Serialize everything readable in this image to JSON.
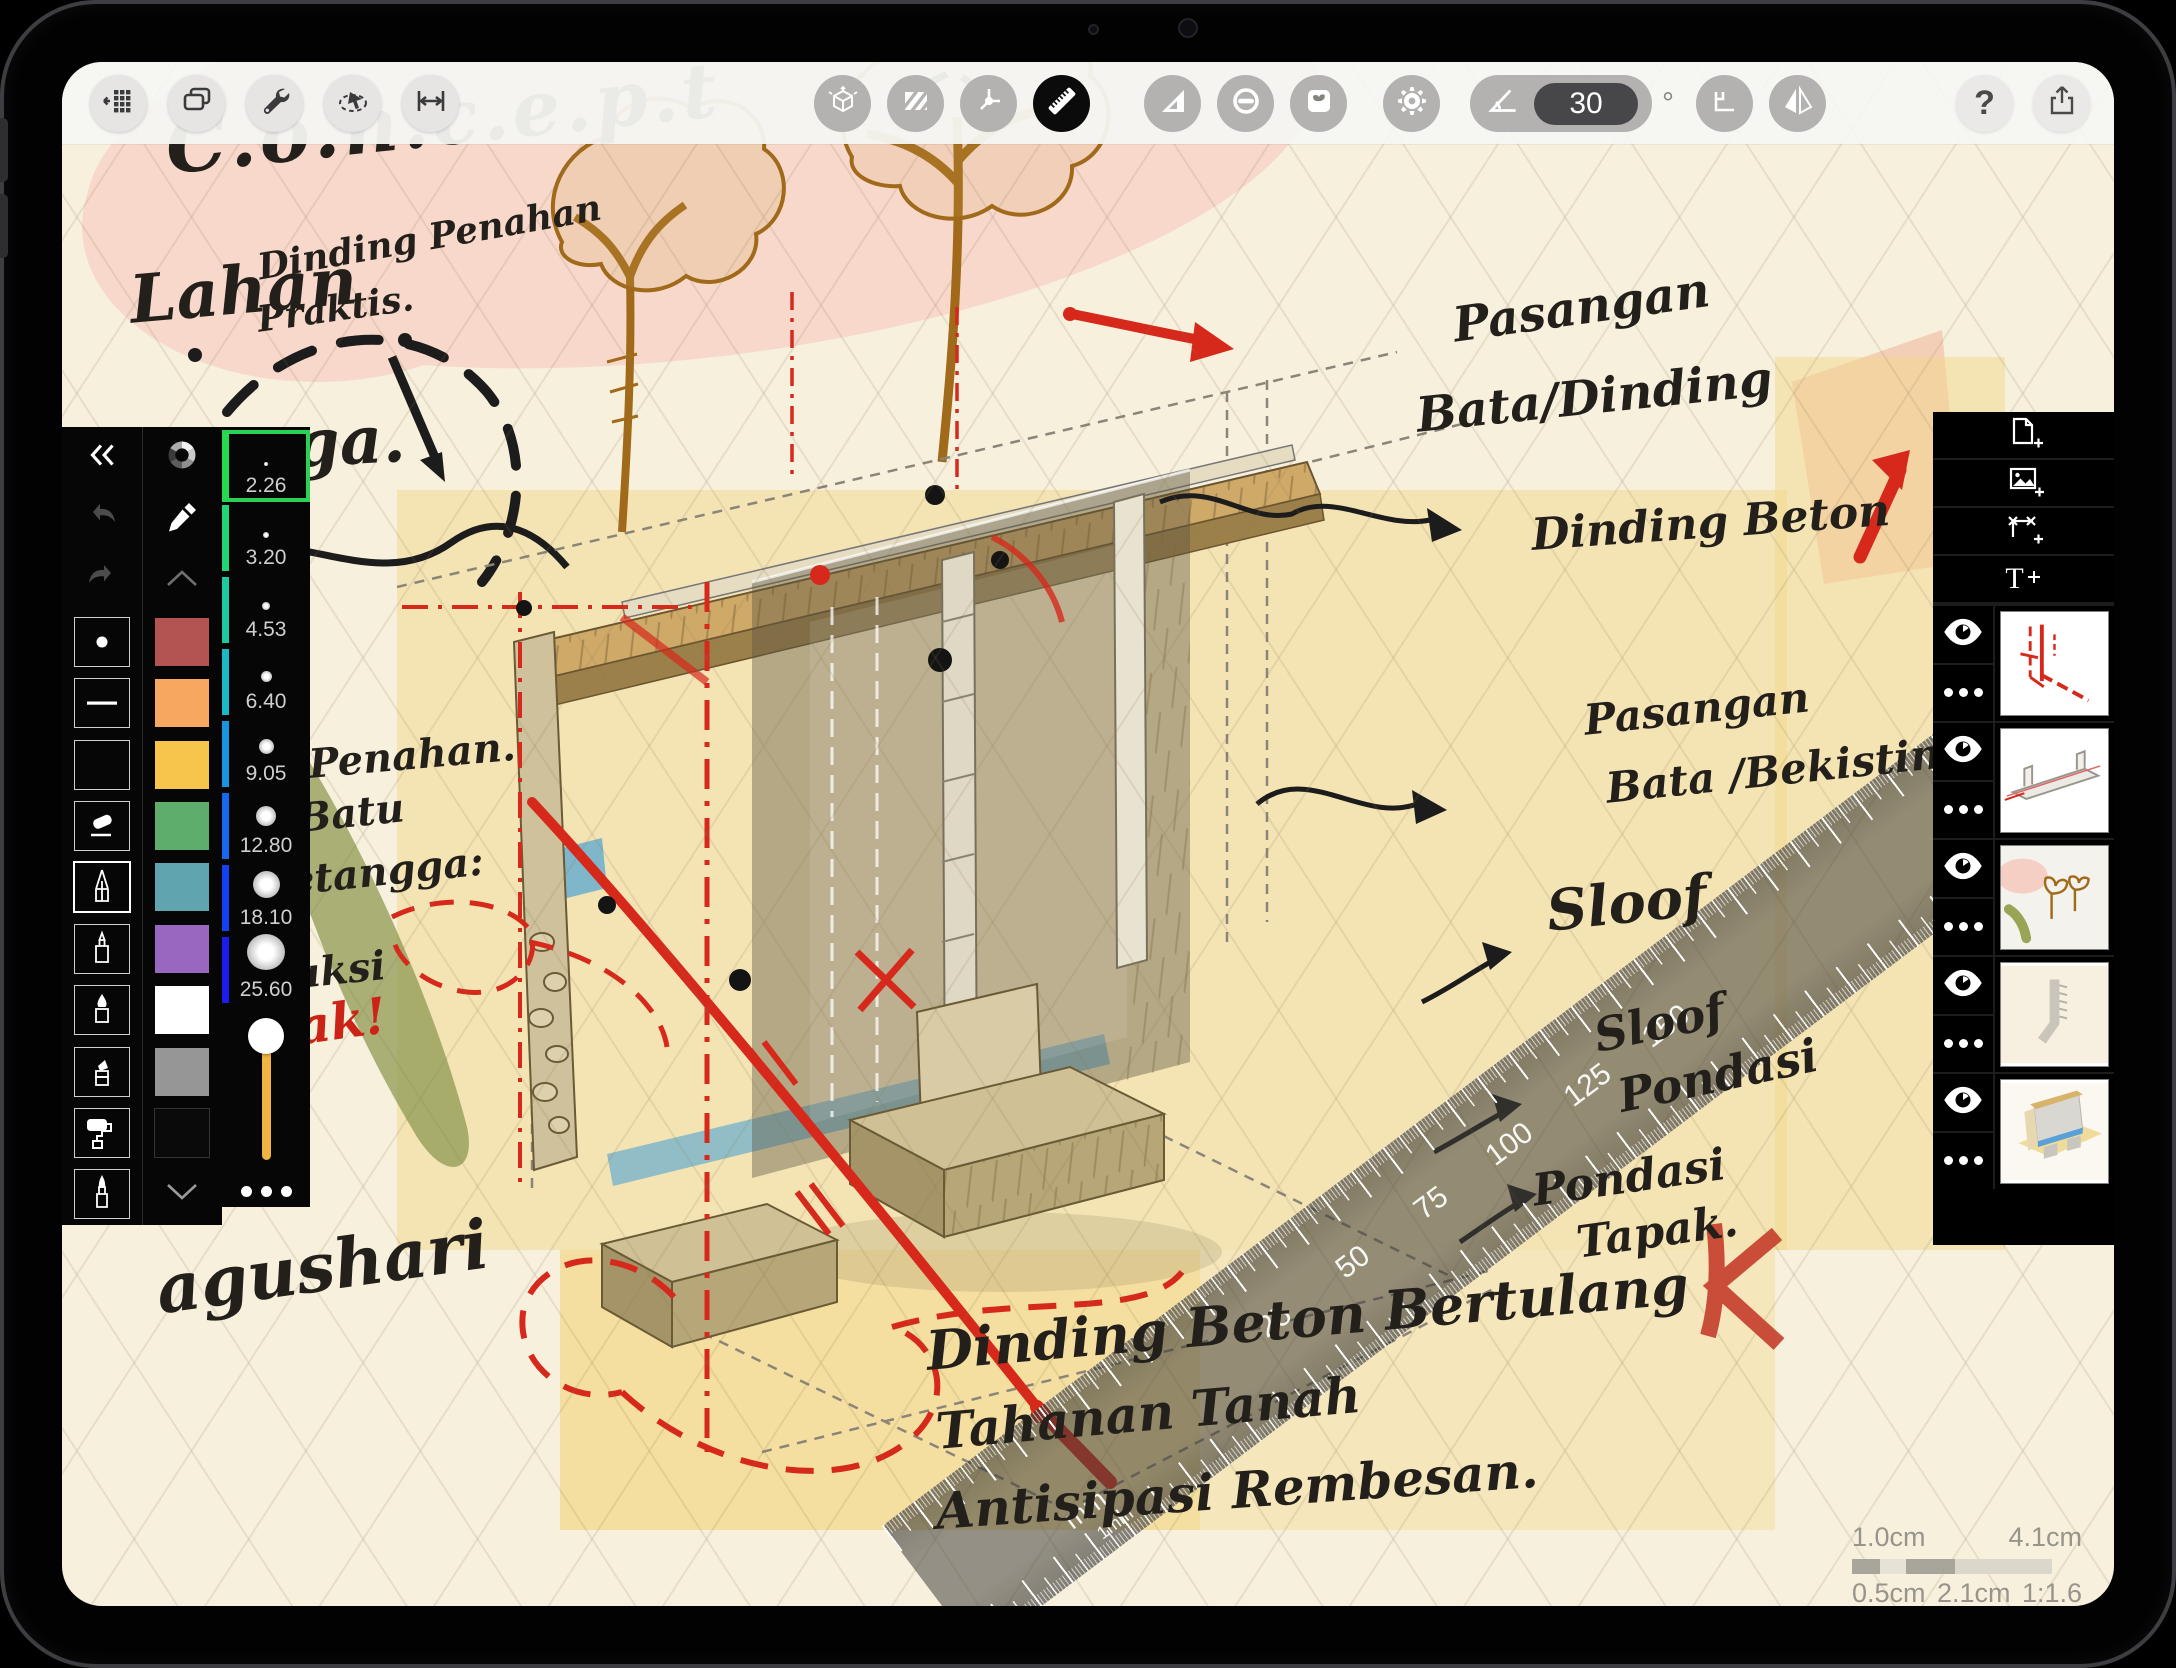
{
  "toolbar": {
    "angle": {
      "value": "30",
      "unit": "°"
    },
    "help_label": "?",
    "icons_left": [
      "projects-grid",
      "duplicate",
      "wrench",
      "select-lasso",
      "measure-span"
    ],
    "icons_center": [
      "iso-grid",
      "fill-hatch",
      "axes",
      "ruler",
      "set-square",
      "protractor",
      "sticker",
      "settings",
      "angle-control",
      "snap-corner",
      "flip-horizontal"
    ],
    "icons_right": [
      "help",
      "share"
    ]
  },
  "tool_panel": {
    "header_icons": [
      "collapse",
      "undo",
      "redo"
    ],
    "tools": [
      "dot",
      "line",
      "rectangle",
      "eraser",
      "pencil",
      "fineliner",
      "brush",
      "marker",
      "roller",
      "pen"
    ],
    "active_tool": "pencil",
    "swatches": [
      "#b35352",
      "#f7a75f",
      "#f8c54c",
      "#5ead6c",
      "#5fa4ae",
      "#9a67c0",
      "#ffffff",
      "#969696",
      "#0a0a0a"
    ],
    "sizes": [
      {
        "value": "2.26",
        "strip": "#27d94f"
      },
      {
        "value": "3.20",
        "strip": "#22d474"
      },
      {
        "value": "4.53",
        "strip": "#1fc9a0"
      },
      {
        "value": "6.40",
        "strip": "#1bb9c4"
      },
      {
        "value": "9.05",
        "strip": "#1795e0"
      },
      {
        "value": "12.80",
        "strip": "#1668ef"
      },
      {
        "value": "18.10",
        "strip": "#1242f2"
      },
      {
        "value": "25.60",
        "strip": "#1a1df0"
      }
    ],
    "selected_size": "2.26",
    "slider_color": "#f0b443"
  },
  "layers_panel": {
    "buttons": [
      "add-page",
      "add-image",
      "add-frame",
      "add-text"
    ],
    "text_button_label": "T",
    "layers": [
      {
        "name": "red-annotations"
      },
      {
        "name": "beam-structure"
      },
      {
        "name": "trees-background"
      },
      {
        "name": "wall-profile"
      },
      {
        "name": "color-render"
      }
    ]
  },
  "ruler": {
    "unit": "mm",
    "subunit": "1mm",
    "labels": [
      "25",
      "50",
      "75",
      "100",
      "125",
      "150"
    ]
  },
  "scale_legend": {
    "top_left": "1.0cm",
    "top_right": "4.1cm",
    "bottom_left": "0.5cm",
    "bottom_center": "2.1cm",
    "ratio": "1:1.6"
  },
  "annotations": {
    "title": "C.o.n.c.e.p.t",
    "subtitle_line1": "Dinding Penahan",
    "subtitle_line2": "Praktis.",
    "lahan": "Lahan",
    "tangga_fragment": "angga.",
    "penahan_fragment": "Penahan.",
    "batu_fragment": "T Batu",
    "tetangga_fragment": "etangga:",
    "konstruksi_fragment": "truksi",
    "layak_fragment": "layak!",
    "pasangan1_line1": "Pasangan",
    "pasangan1_line2": "Bata/Dinding",
    "dinding_beton": "Dinding Beton",
    "pasangan2_line1": "Pasangan",
    "pasangan2_line2": "Bata /Bekisting.",
    "sloof": "Sloof",
    "sloof_pondasi_line1": "Sloof",
    "sloof_pondasi_line2": "Pondasi",
    "pondasi_tapak_line1": "Pondasi",
    "pondasi_tapak_line2": "Tapak.",
    "bottom_line1": "Dinding Beton Bertulang",
    "bottom_line2": "Tahanan Tanah",
    "bottom_line3": "Antisipasi Rembesan.",
    "signature": "agushari"
  }
}
